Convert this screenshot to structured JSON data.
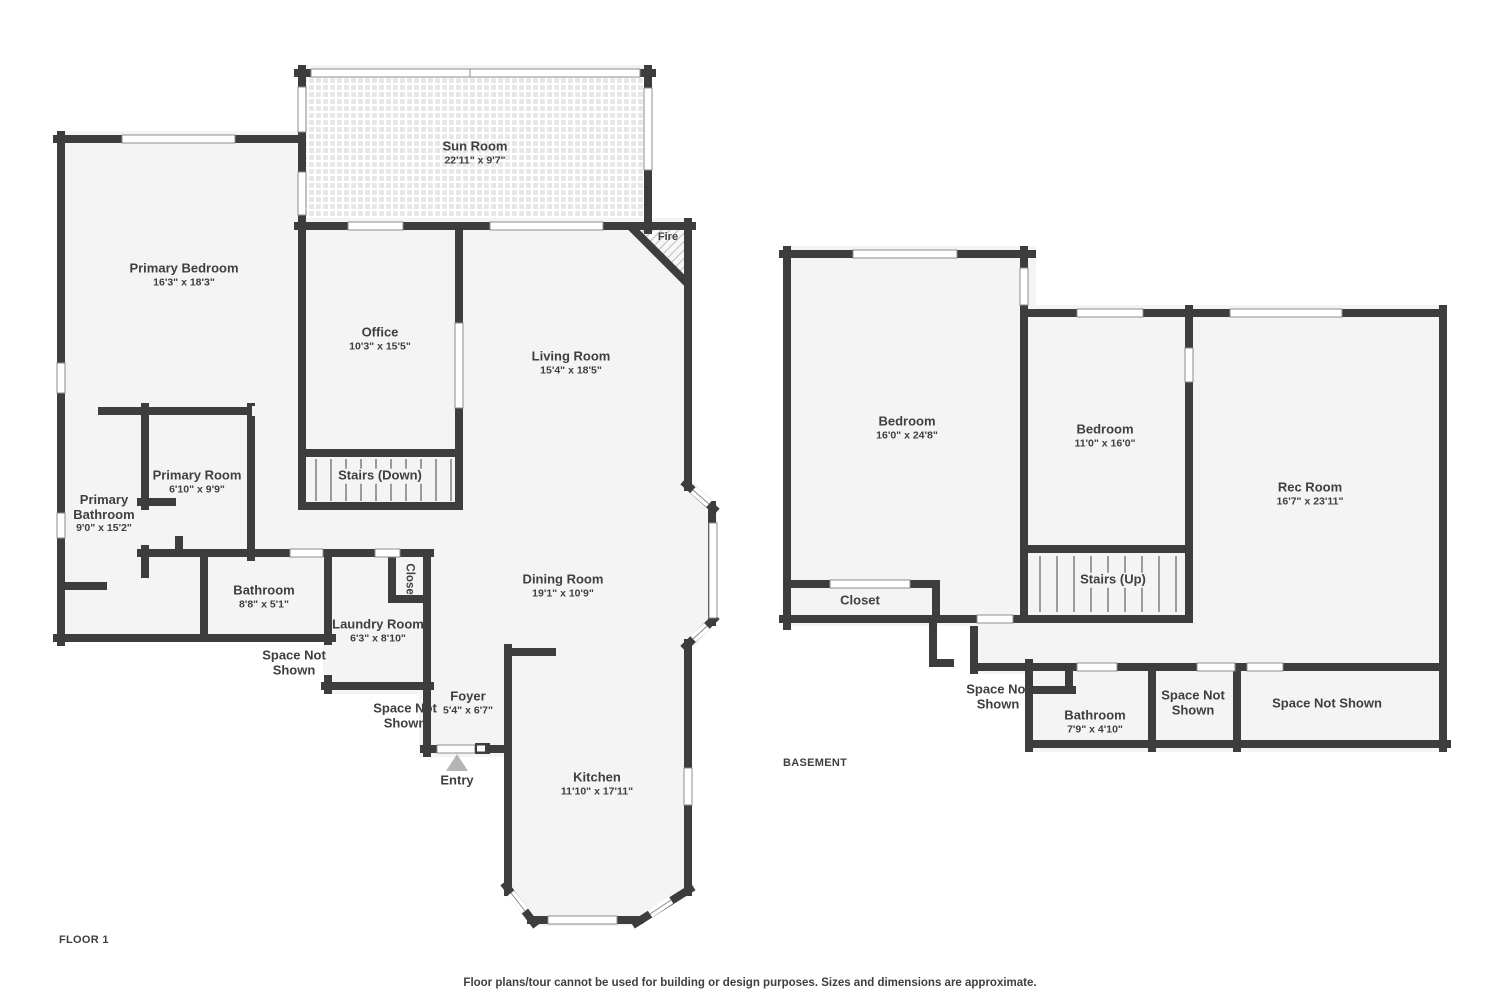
{
  "floor1": {
    "title": "FLOOR 1",
    "rooms": [
      {
        "name": "Sun Room",
        "dims": "22'11\" x 9'7\""
      },
      {
        "name": "Primary Bedroom",
        "dims": "16'3\" x 18'3\""
      },
      {
        "name": "Office",
        "dims": "10'3\" x 15'5\""
      },
      {
        "name": "Living Room",
        "dims": "15'4\" x 18'5\""
      },
      {
        "name": "Primary Room",
        "dims": "6'10\" x 9'9\""
      },
      {
        "name": "Primary Bathroom",
        "dims": "9'0\" x 15'2\""
      },
      {
        "name": "Stairs (Down)"
      },
      {
        "name": "Bathroom",
        "dims": "8'8\" x 5'1\""
      },
      {
        "name": "Laundry Room",
        "dims": "6'3\" x 8'10\""
      },
      {
        "name": "Closet"
      },
      {
        "name": "Dining Room",
        "dims": "19'1\" x 10'9\""
      },
      {
        "name": "Foyer",
        "dims": "5'4\" x 6'7\""
      },
      {
        "name": "Kitchen",
        "dims": "11'10\" x 17'11\""
      },
      {
        "name": "Space Not Shown"
      },
      {
        "name": "Space Not Shown"
      },
      {
        "name": "Entry"
      },
      {
        "name": "Fire"
      }
    ]
  },
  "basement": {
    "title": "BASEMENT",
    "rooms": [
      {
        "name": "Bedroom",
        "dims": "16'0\" x 24'8\""
      },
      {
        "name": "Bedroom",
        "dims": "11'0\" x 16'0\""
      },
      {
        "name": "Rec Room",
        "dims": "16'7\" x 23'11\""
      },
      {
        "name": "Stairs (Up)"
      },
      {
        "name": "Closet"
      },
      {
        "name": "Bathroom",
        "dims": "7'9\" x 4'10\""
      },
      {
        "name": "Space Not Shown"
      },
      {
        "name": "Space Not Shown"
      },
      {
        "name": "Space Not Shown"
      }
    ]
  },
  "footer": {
    "disclaimer": "Floor plans/tour cannot be used for building or design purposes. Sizes and dimensions are approximate."
  },
  "colors": {
    "wall": "#3d3d3d",
    "floor": "#f4f4f4",
    "text": "#3f3f3f",
    "tread": "#9b9b9b",
    "window_frame": "#8d8d8d",
    "entry_marker": "#b5b5b5"
  }
}
